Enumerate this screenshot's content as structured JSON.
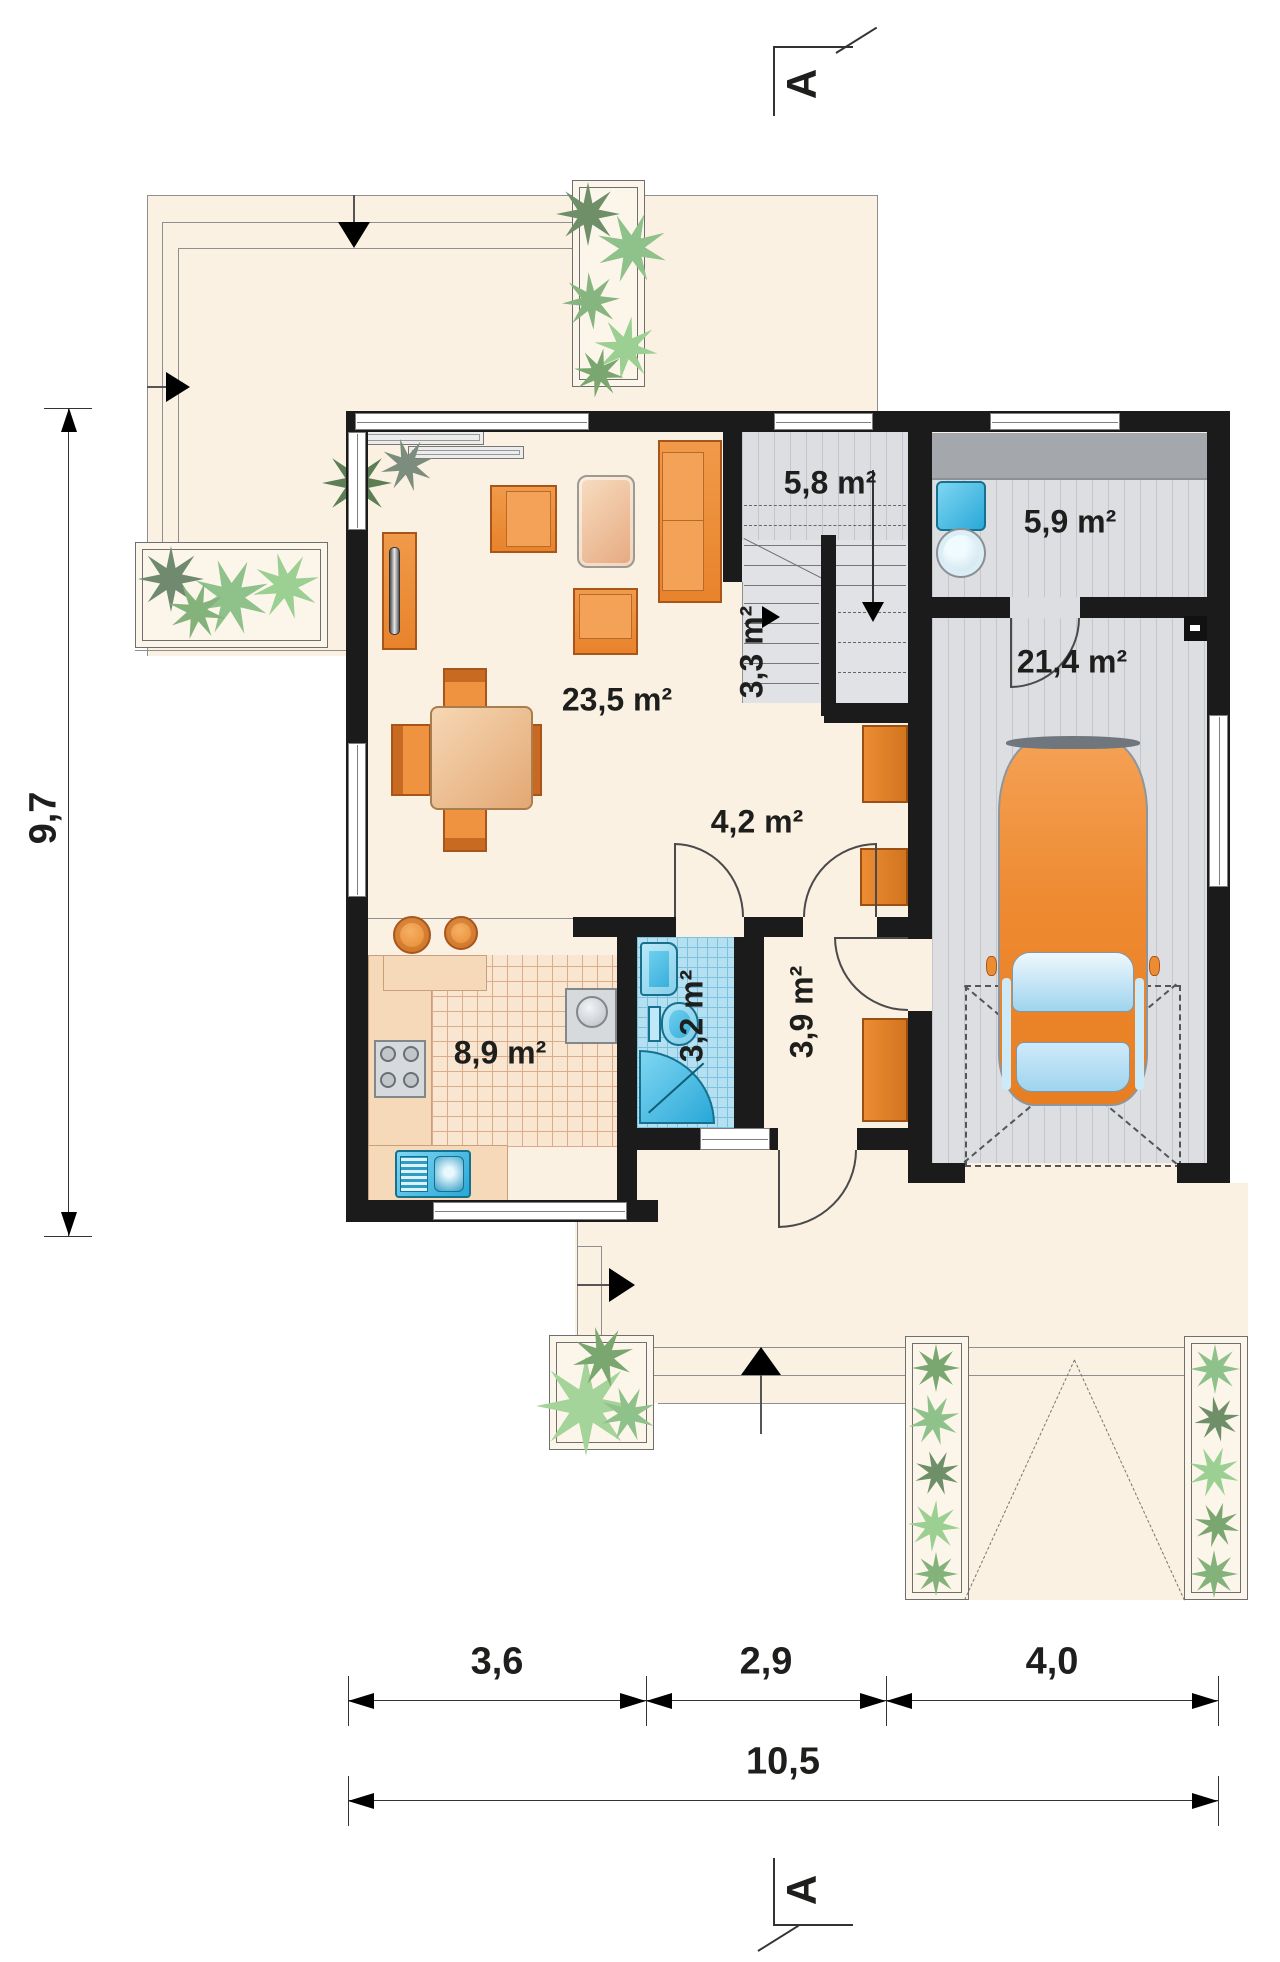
{
  "section": {
    "label": "A"
  },
  "rooms": {
    "living": "23,5 m²",
    "kitchen": "8,9 m²",
    "bathroom": "3,2 m²",
    "hall": "3,9 m²",
    "vestibule": "4,2 m²",
    "staircase": "5,8 m²",
    "staircase_lower": "3,3 m²",
    "utility": "5,9 m²",
    "garage": "21,4 m²"
  },
  "dimensions": {
    "height_total": "9,7",
    "width_segments": [
      "3,6",
      "2,9",
      "4,0"
    ],
    "width_total": "10,5"
  },
  "colors": {
    "floor_cream": "#faf1e3",
    "wall_black": "#1b1b1b",
    "furniture_orange": "#ec8c33",
    "water_blue": "#3cb6e4",
    "floor_gray": "#dcdee1",
    "plant_green": "#8fc18b"
  }
}
